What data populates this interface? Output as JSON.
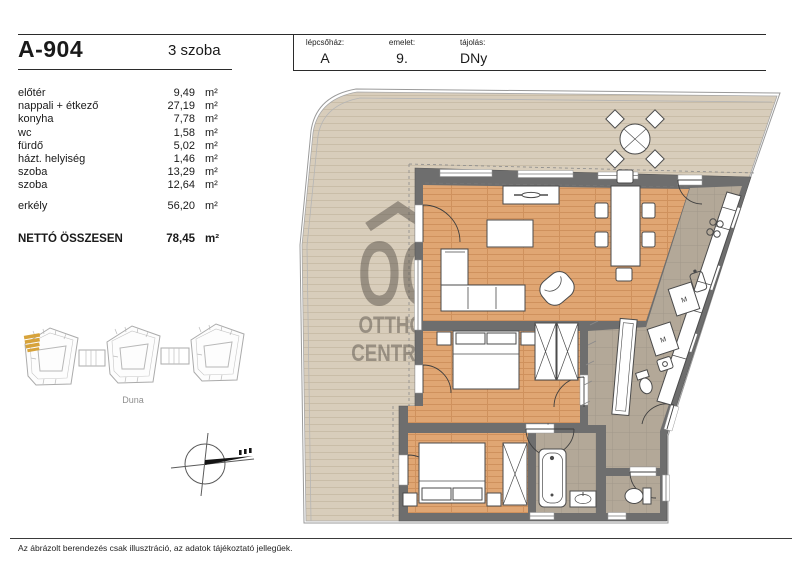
{
  "header": {
    "unit_id": "A-904",
    "room_count": "3 szoba",
    "staircase_label": "lépcsőház:",
    "staircase_value": "A",
    "floor_label": "emelet:",
    "floor_value": "9.",
    "orientation_label": "tájolás:",
    "orientation_value": "DNy"
  },
  "room_table": {
    "rows": [
      {
        "name": "előtér",
        "area": "9,49",
        "unit": "m²"
      },
      {
        "name": "nappali + étkező",
        "area": "27,19",
        "unit": "m²"
      },
      {
        "name": "konyha",
        "area": "7,78",
        "unit": "m²"
      },
      {
        "name": "wc",
        "area": "1,58",
        "unit": "m²"
      },
      {
        "name": "fürdő",
        "area": "5,02",
        "unit": "m²"
      },
      {
        "name": "házt. helyiség",
        "area": "1,46",
        "unit": "m²"
      },
      {
        "name": "szoba",
        "area": "13,29",
        "unit": "m²"
      },
      {
        "name": "szoba",
        "area": "12,64",
        "unit": "m²"
      }
    ],
    "balcony": {
      "name": "erkély",
      "area": "56,20",
      "unit": "m²"
    },
    "total": {
      "name": "NETTÓ ÖSSZESEN",
      "area": "78,45",
      "unit": "m²"
    }
  },
  "site_plan": {
    "river_label": "Duna"
  },
  "watermark": {
    "monogram": "OC",
    "line1": "OTTHON",
    "line2": "CENTRUM"
  },
  "appliances": {
    "washer_label": "M"
  },
  "footer": {
    "disclaimer": "Az ábrázolt berendezés csak illusztráció, az adatok tájékoztató jellegűek."
  },
  "colors": {
    "wall": "#6e6e6e",
    "wood_floor": "#e0a673",
    "deck": "#d8cdbb",
    "tile": "#b3a898",
    "highlight": "#d7a33b"
  }
}
